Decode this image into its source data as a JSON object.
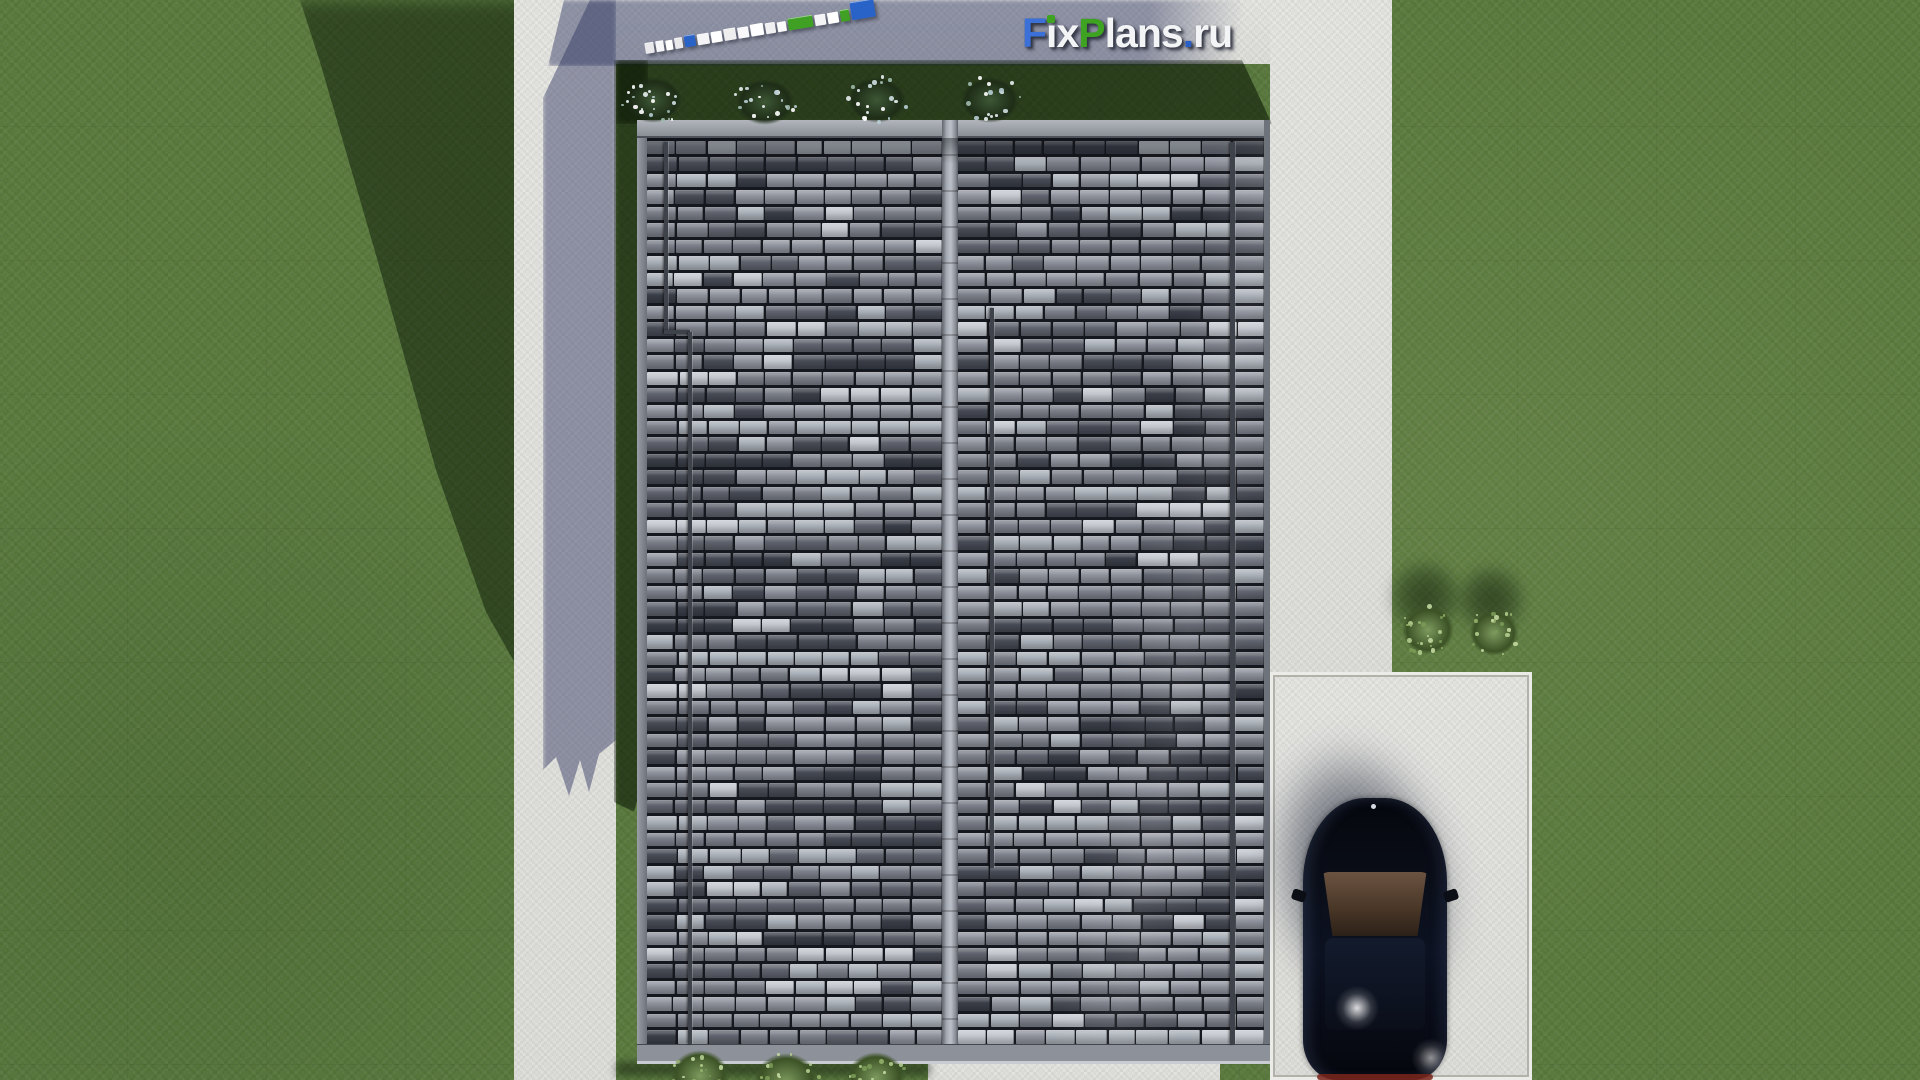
{
  "scene": {
    "title": "FixPlans.ru — 3D top view render of house plot with roof, lawn, paths and car",
    "watermark": {
      "text": "FixPlans.ru",
      "letters": [
        {
          "ch": "F",
          "color": "#3a70d8"
        },
        {
          "ch": "i",
          "color": "#f2f4f6",
          "dot": "#3fa322"
        },
        {
          "ch": "x",
          "color": "#f2f4f6"
        },
        {
          "ch": "P",
          "color": "#3fa322"
        },
        {
          "ch": "l",
          "color": "#f2f4f6"
        },
        {
          "ch": "a",
          "color": "#f2f4f6"
        },
        {
          "ch": "n",
          "color": "#f2f4f6"
        },
        {
          "ch": "s",
          "color": "#f2f4f6"
        },
        {
          "ch": ".",
          "color": "#2a5fc6"
        },
        {
          "ch": "r",
          "color": "#f2f4f6"
        },
        {
          "ch": "u",
          "color": "#f2f4f6"
        }
      ]
    },
    "palette": {
      "grass": "#5a7a3e",
      "grass_shadow": "#2e431f",
      "concrete_lit": "#e3e3e0",
      "concrete_shadow": "#8f93a6",
      "roof_ridge": "#a7acb4",
      "roof_fascia": "#82868e",
      "car_body": "#0a0e18",
      "car_glass_brown": "#5a4332",
      "car_taillight": "#7a241a",
      "bush_green": "#6f8d52",
      "flower_speckle": "#e8eef2"
    },
    "roof": {
      "tile_palette": [
        "#c2c6cd",
        "#aab0b8",
        "#aab0b8",
        "#8f939d",
        "#8f939d",
        "#8f939d",
        "#7b7f89",
        "#7b7f89",
        "#7b7f89",
        "#5f636d",
        "#5f636d",
        "#474b55",
        "#474b55",
        "#3a3e48"
      ],
      "rows": 55,
      "cols_left": 10,
      "cols_right": 10,
      "seed": 11,
      "run_probability": 0.38
    },
    "scale_bar": {
      "segments": [
        {
          "color": "#e9e9ec",
          "w": 9,
          "h": 11
        },
        {
          "color": "#f6f6f8",
          "w": 8,
          "h": 11
        },
        {
          "color": "#ffffff",
          "w": 7,
          "h": 10
        },
        {
          "color": "#e9e9ec",
          "w": 8,
          "h": 11
        },
        {
          "color": "#2a63c8",
          "w": 11,
          "h": 12
        },
        {
          "color": "#f4f4f6",
          "w": 12,
          "h": 11
        },
        {
          "color": "#ffffff",
          "w": 11,
          "h": 11
        },
        {
          "color": "#eeeeef",
          "w": 12,
          "h": 12
        },
        {
          "color": "#f8f8fa",
          "w": 11,
          "h": 11
        },
        {
          "color": "#ffffff",
          "w": 13,
          "h": 12
        },
        {
          "color": "#f0f0f2",
          "w": 10,
          "h": 11
        },
        {
          "color": "#fafafa",
          "w": 9,
          "h": 10
        },
        {
          "color": "#3fa024",
          "w": 25,
          "h": 12
        },
        {
          "color": "#f4f4f6",
          "w": 11,
          "h": 11
        },
        {
          "color": "#ffffff",
          "w": 11,
          "h": 11
        },
        {
          "color": "#3fa024",
          "w": 9,
          "h": 12
        },
        {
          "color": "#2a63c8",
          "w": 24,
          "h": 18
        }
      ]
    },
    "bushes": {
      "flower_top": [
        [
          653,
          100
        ],
        [
          765,
          102
        ],
        [
          877,
          100
        ],
        [
          990,
          100
        ]
      ],
      "green_right": [
        [
          1428,
          630,
          34
        ],
        [
          1494,
          633,
          32
        ]
      ],
      "green_bottom": [
        [
          700,
          1076,
          38
        ],
        [
          786,
          1082,
          42
        ],
        [
          876,
          1078,
          38
        ]
      ]
    }
  }
}
